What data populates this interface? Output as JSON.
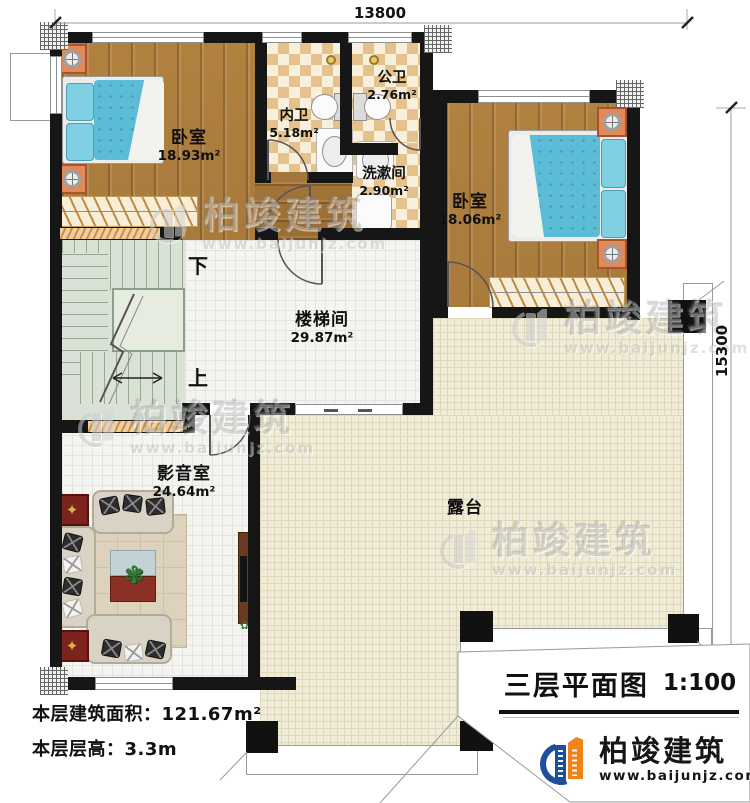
{
  "plan": {
    "dimensions": {
      "top": "13800",
      "right": "15300"
    },
    "rooms": [
      {
        "name": "卧室",
        "area": "18.93m²"
      },
      {
        "name": "内卫",
        "area": "5.18m²"
      },
      {
        "name": "公卫",
        "area": "2.76m²"
      },
      {
        "name": "洗漱间",
        "area": "2.90m²"
      },
      {
        "name": "卧室",
        "area": "18.06m²"
      },
      {
        "name": "楼梯间",
        "area": "29.87m²"
      },
      {
        "name": "影音室",
        "area": "24.64m²"
      },
      {
        "name": "露台",
        "area": ""
      }
    ],
    "stairs": {
      "down_label": "下",
      "up_label": "上"
    },
    "notes": [
      {
        "label": "本层建筑面积：",
        "value": "121.67m²"
      },
      {
        "label": "本层层高：",
        "value": "3.3m"
      }
    ],
    "title_block": {
      "title": "三层平面图",
      "scale": "1:100"
    },
    "brand": {
      "name": "柏竣建筑",
      "website": "www.baijunjz.com"
    },
    "watermark": {
      "name": "柏竣建筑",
      "website": "www.baijunjz.com"
    },
    "colors": {
      "wall": "#161616",
      "wood_floor": "#ad7c40",
      "bath_tile": "#e5c18b",
      "stair_floor": "#d9e2d5",
      "terrace": "#f0ecd7",
      "bed_blue": "#5cbcd6",
      "nightstand_orange": "#e08a5c",
      "logo_blue": "#1d4f9e",
      "logo_orange": "#f08318"
    }
  }
}
